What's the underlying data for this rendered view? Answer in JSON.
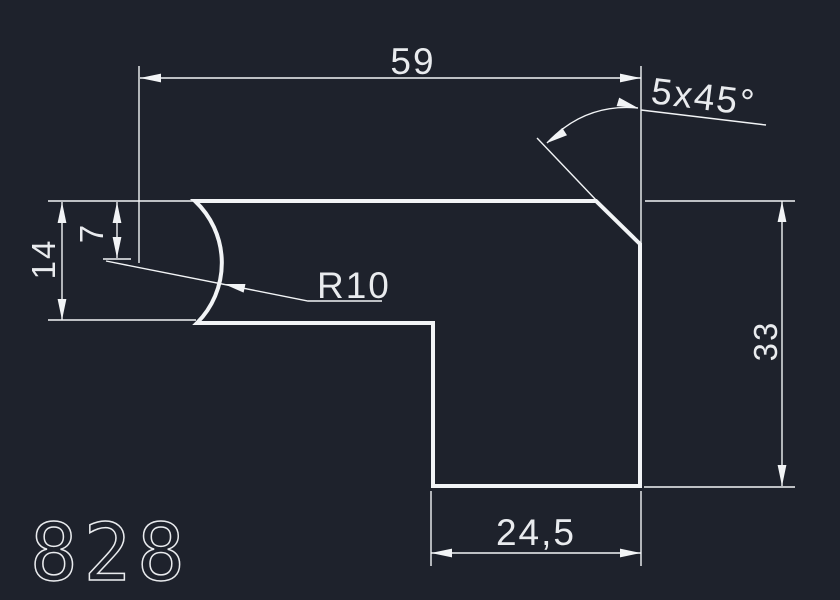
{
  "drawing": {
    "colors": {
      "background": "#1e222c",
      "line": "#f2f4f6",
      "text": "#e9ebee"
    },
    "labels": {
      "dim_width": "59",
      "chamfer": "5x45°",
      "dim_thickness": "14",
      "dim_arc_offset": "7",
      "radius": "R10",
      "dim_height": "33",
      "dim_leg_width": "24,5",
      "part_number": "828"
    }
  }
}
